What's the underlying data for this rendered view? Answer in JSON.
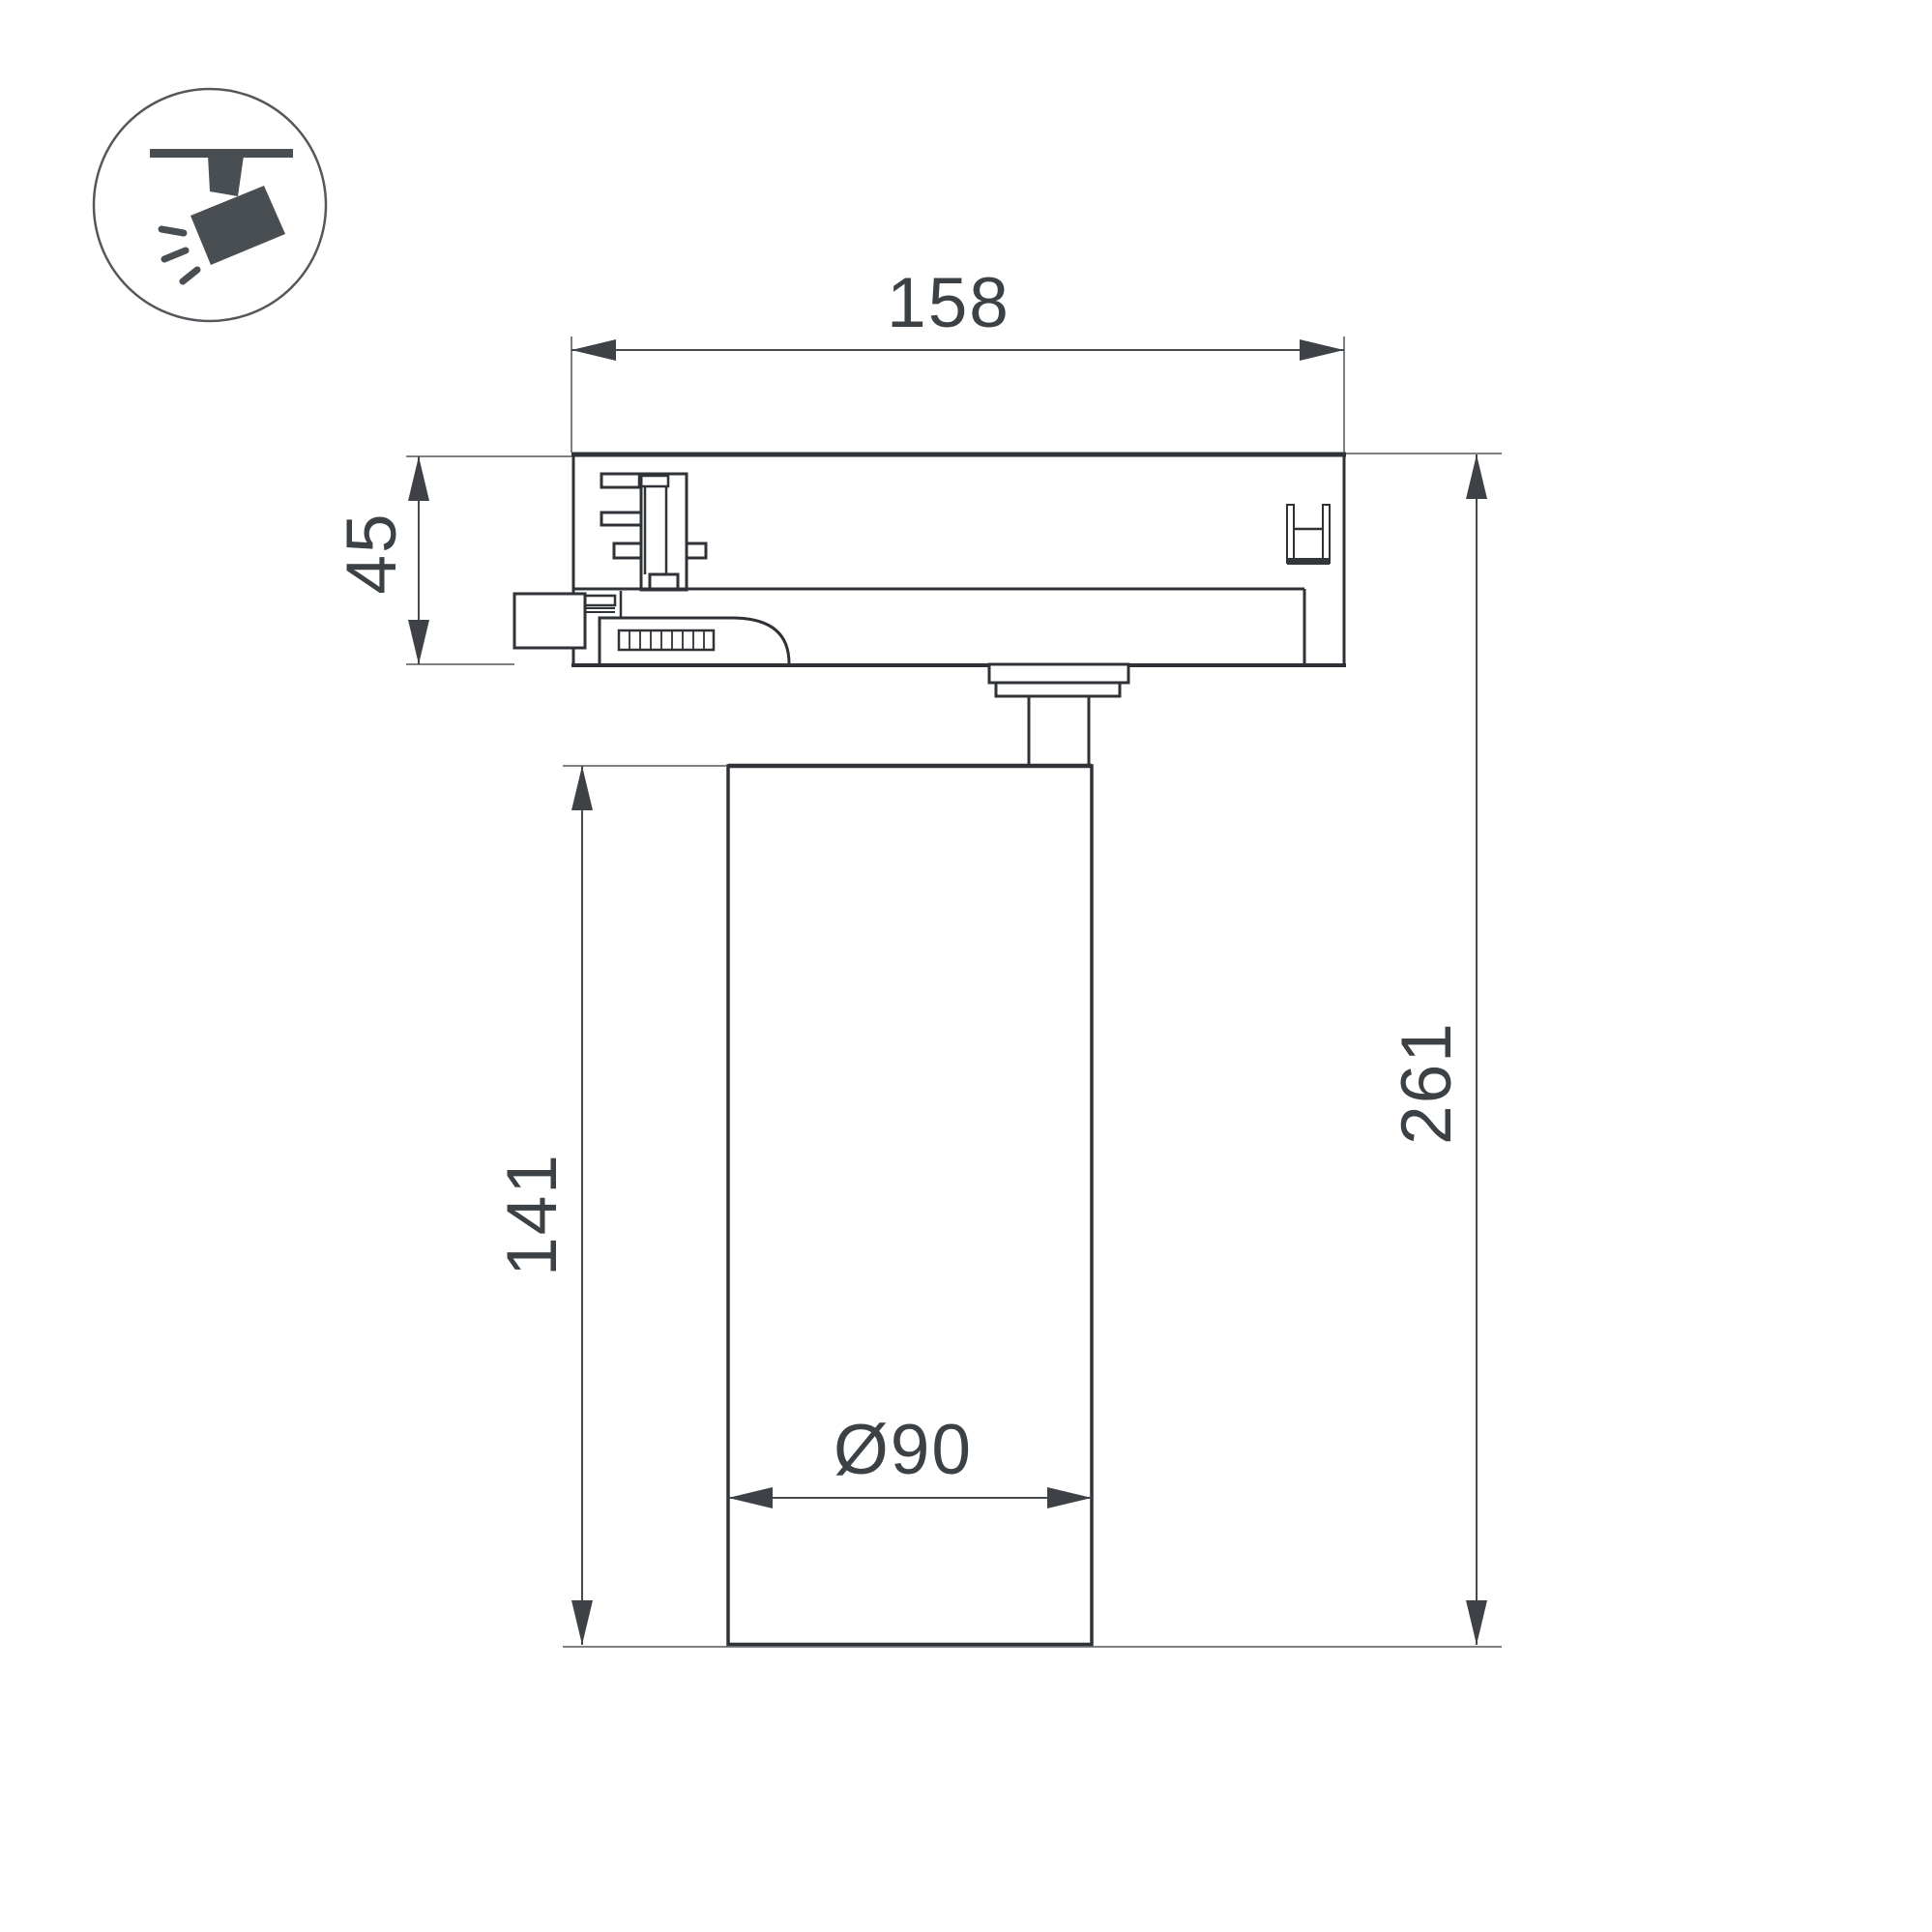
{
  "drawing": {
    "title": "track spotlight technical drawing side view",
    "icon": {
      "name": "track-spotlight-icon"
    },
    "dims": {
      "width": "158",
      "adapter_height": "45",
      "body_height": "141",
      "total_height": "261",
      "diameter": "Ø90"
    },
    "colors": {
      "background": "#ffffff",
      "outline": "#2f3337",
      "dimension_line": "#46494d",
      "extension_line": "#6b6f73",
      "text": "#3c4145",
      "icon_glyph": "#494e53"
    }
  }
}
